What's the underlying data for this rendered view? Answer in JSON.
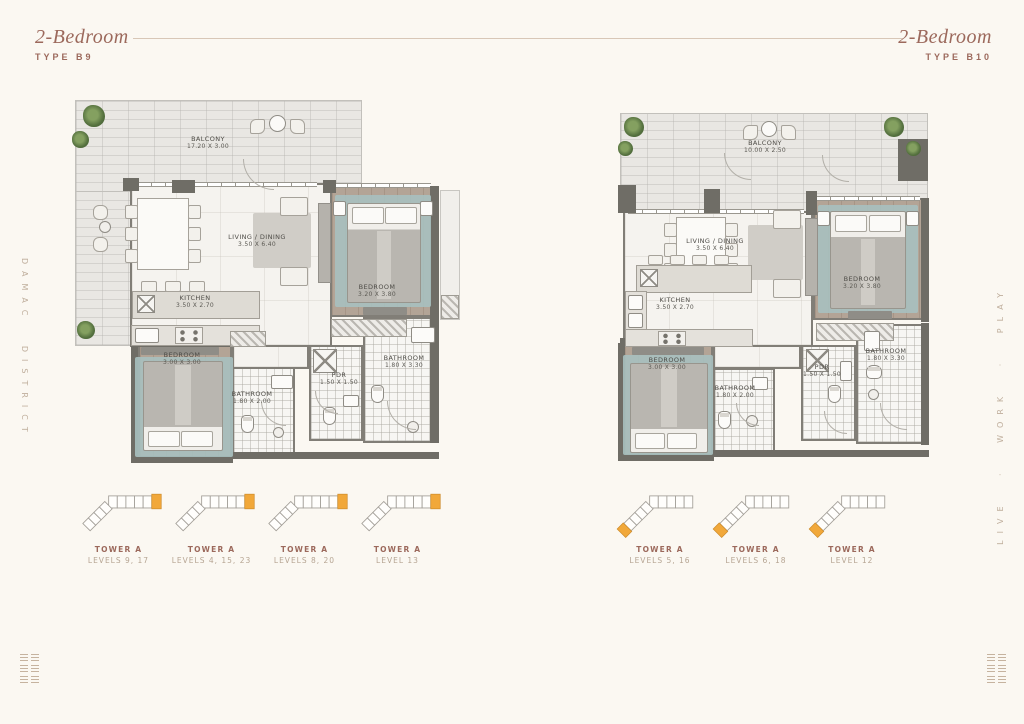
{
  "page": {
    "side_left": "DAMAC DISTRICT",
    "side_right": "LIVE · WORK · PLAY"
  },
  "colors": {
    "accent": "#9c695c",
    "keyplan_highlight": "#f1a83a"
  },
  "plans": [
    {
      "title": "2-Bedroom",
      "type_label": "TYPE B9",
      "rooms": {
        "balcony": {
          "name": "BALCONY",
          "dims": "17.20 X 3.00"
        },
        "living": {
          "name": "LIVING / DINING",
          "dims": "3.50 X 6.40"
        },
        "kitchen": {
          "name": "KITCHEN",
          "dims": "3.50 X 2.70"
        },
        "bedroom1": {
          "name": "BEDROOM",
          "dims": "3.20 X 3.80"
        },
        "bedroom2": {
          "name": "BEDROOM",
          "dims": "3.00 X 3.00"
        },
        "bathroom1": {
          "name": "BATHROOM",
          "dims": "1.80 X 2.00"
        },
        "pdr": {
          "name": "PDR",
          "dims": "1.50 X 1.50"
        },
        "bathroom2": {
          "name": "BATHROOM",
          "dims": "1.80 X 3.30"
        }
      },
      "keyplans": [
        {
          "tower": "TOWER A",
          "levels": "LEVELS 9, 17"
        },
        {
          "tower": "TOWER A",
          "levels": "LEVELS 4, 15, 23"
        },
        {
          "tower": "TOWER A",
          "levels": "LEVELS 8, 20"
        },
        {
          "tower": "TOWER A",
          "levels": "LEVEL 13"
        }
      ]
    },
    {
      "title": "2-Bedroom",
      "type_label": "TYPE B10",
      "rooms": {
        "balcony": {
          "name": "BALCONY",
          "dims": "10.00 X 2.50"
        },
        "living": {
          "name": "LIVING / DINING",
          "dims": "3.50 X 6.40"
        },
        "kitchen": {
          "name": "KITCHEN",
          "dims": "3.50 X 2.70"
        },
        "bedroom1": {
          "name": "BEDROOM",
          "dims": "3.20 X 3.80"
        },
        "bedroom2": {
          "name": "BEDROOM",
          "dims": "3.00 X 3.00"
        },
        "bathroom1": {
          "name": "BATHROOM",
          "dims": "1.80 X 2.00"
        },
        "pdr": {
          "name": "PDR",
          "dims": "1.50 X 1.50"
        },
        "bathroom2": {
          "name": "BATHROOM",
          "dims": "1.80 X 3.30"
        }
      },
      "keyplans": [
        {
          "tower": "TOWER A",
          "levels": "LEVELS 5, 16"
        },
        {
          "tower": "TOWER A",
          "levels": "LEVELS 6, 18"
        },
        {
          "tower": "TOWER A",
          "levels": "LEVEL 12"
        }
      ]
    }
  ]
}
